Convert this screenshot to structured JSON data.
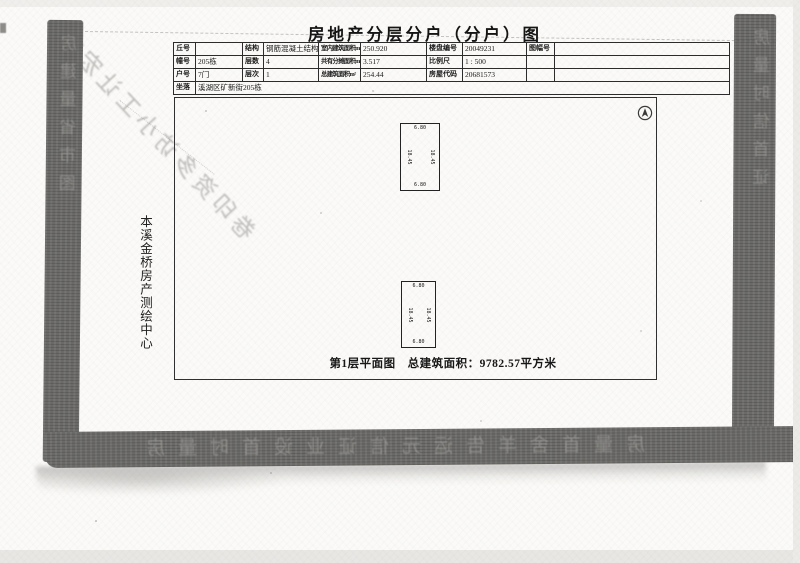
{
  "document": {
    "title": "房地产分层分户（分户）图",
    "agency_vertical_label": "本溪金桥房产测绘中心"
  },
  "info_table": {
    "rows": [
      [
        {
          "label": "丘号",
          "value": ""
        },
        {
          "label": "结构",
          "value": "钢筋混凝土结构"
        },
        {
          "label": "室内建筑面积m²",
          "value": "250.920"
        },
        {
          "label": "楼盘编号",
          "value": "20049231"
        },
        {
          "label": "图幅号",
          "value": ""
        }
      ],
      [
        {
          "label": "幢号",
          "value": "205栋"
        },
        {
          "label": "层数",
          "value": "4"
        },
        {
          "label": "共有分摊面积m²",
          "value": "3.517"
        },
        {
          "label": "比例尺",
          "value": "1 : 500"
        },
        {
          "label": "",
          "value": ""
        }
      ],
      [
        {
          "label": "户号",
          "value": "7门"
        },
        {
          "label": "层次",
          "value": "1"
        },
        {
          "label": "总建筑面积m²",
          "value": "254.44"
        },
        {
          "label": "房屋代码",
          "value": "20681573"
        },
        {
          "label": "",
          "value": ""
        }
      ]
    ],
    "address": {
      "label": "坐落",
      "value": "溪湖区矿新街205栋"
    }
  },
  "floor_plan": {
    "caption": "第1层平面图　总建筑面积：9782.57平方米",
    "units": [
      {
        "top": "6.80",
        "bottom": "6.80",
        "side_left": "18.45",
        "side_right": "18.45"
      },
      {
        "top": "6.80",
        "bottom": "6.80",
        "side_left": "18.45",
        "side_right": "18.45"
      }
    ]
  },
  "ghost_artifacts": {
    "diagonal_text": "市宏让工小访多资印卷",
    "bottom_band_text": "房量时首设业证信元运告羊舍首量房",
    "left_band_text": "房建量省市图",
    "right_band_text": "房量时信首证"
  },
  "colors": {
    "band_gray": "#6b6a68",
    "paper": "#fbfaf8",
    "ink": "#1c1c1c"
  }
}
